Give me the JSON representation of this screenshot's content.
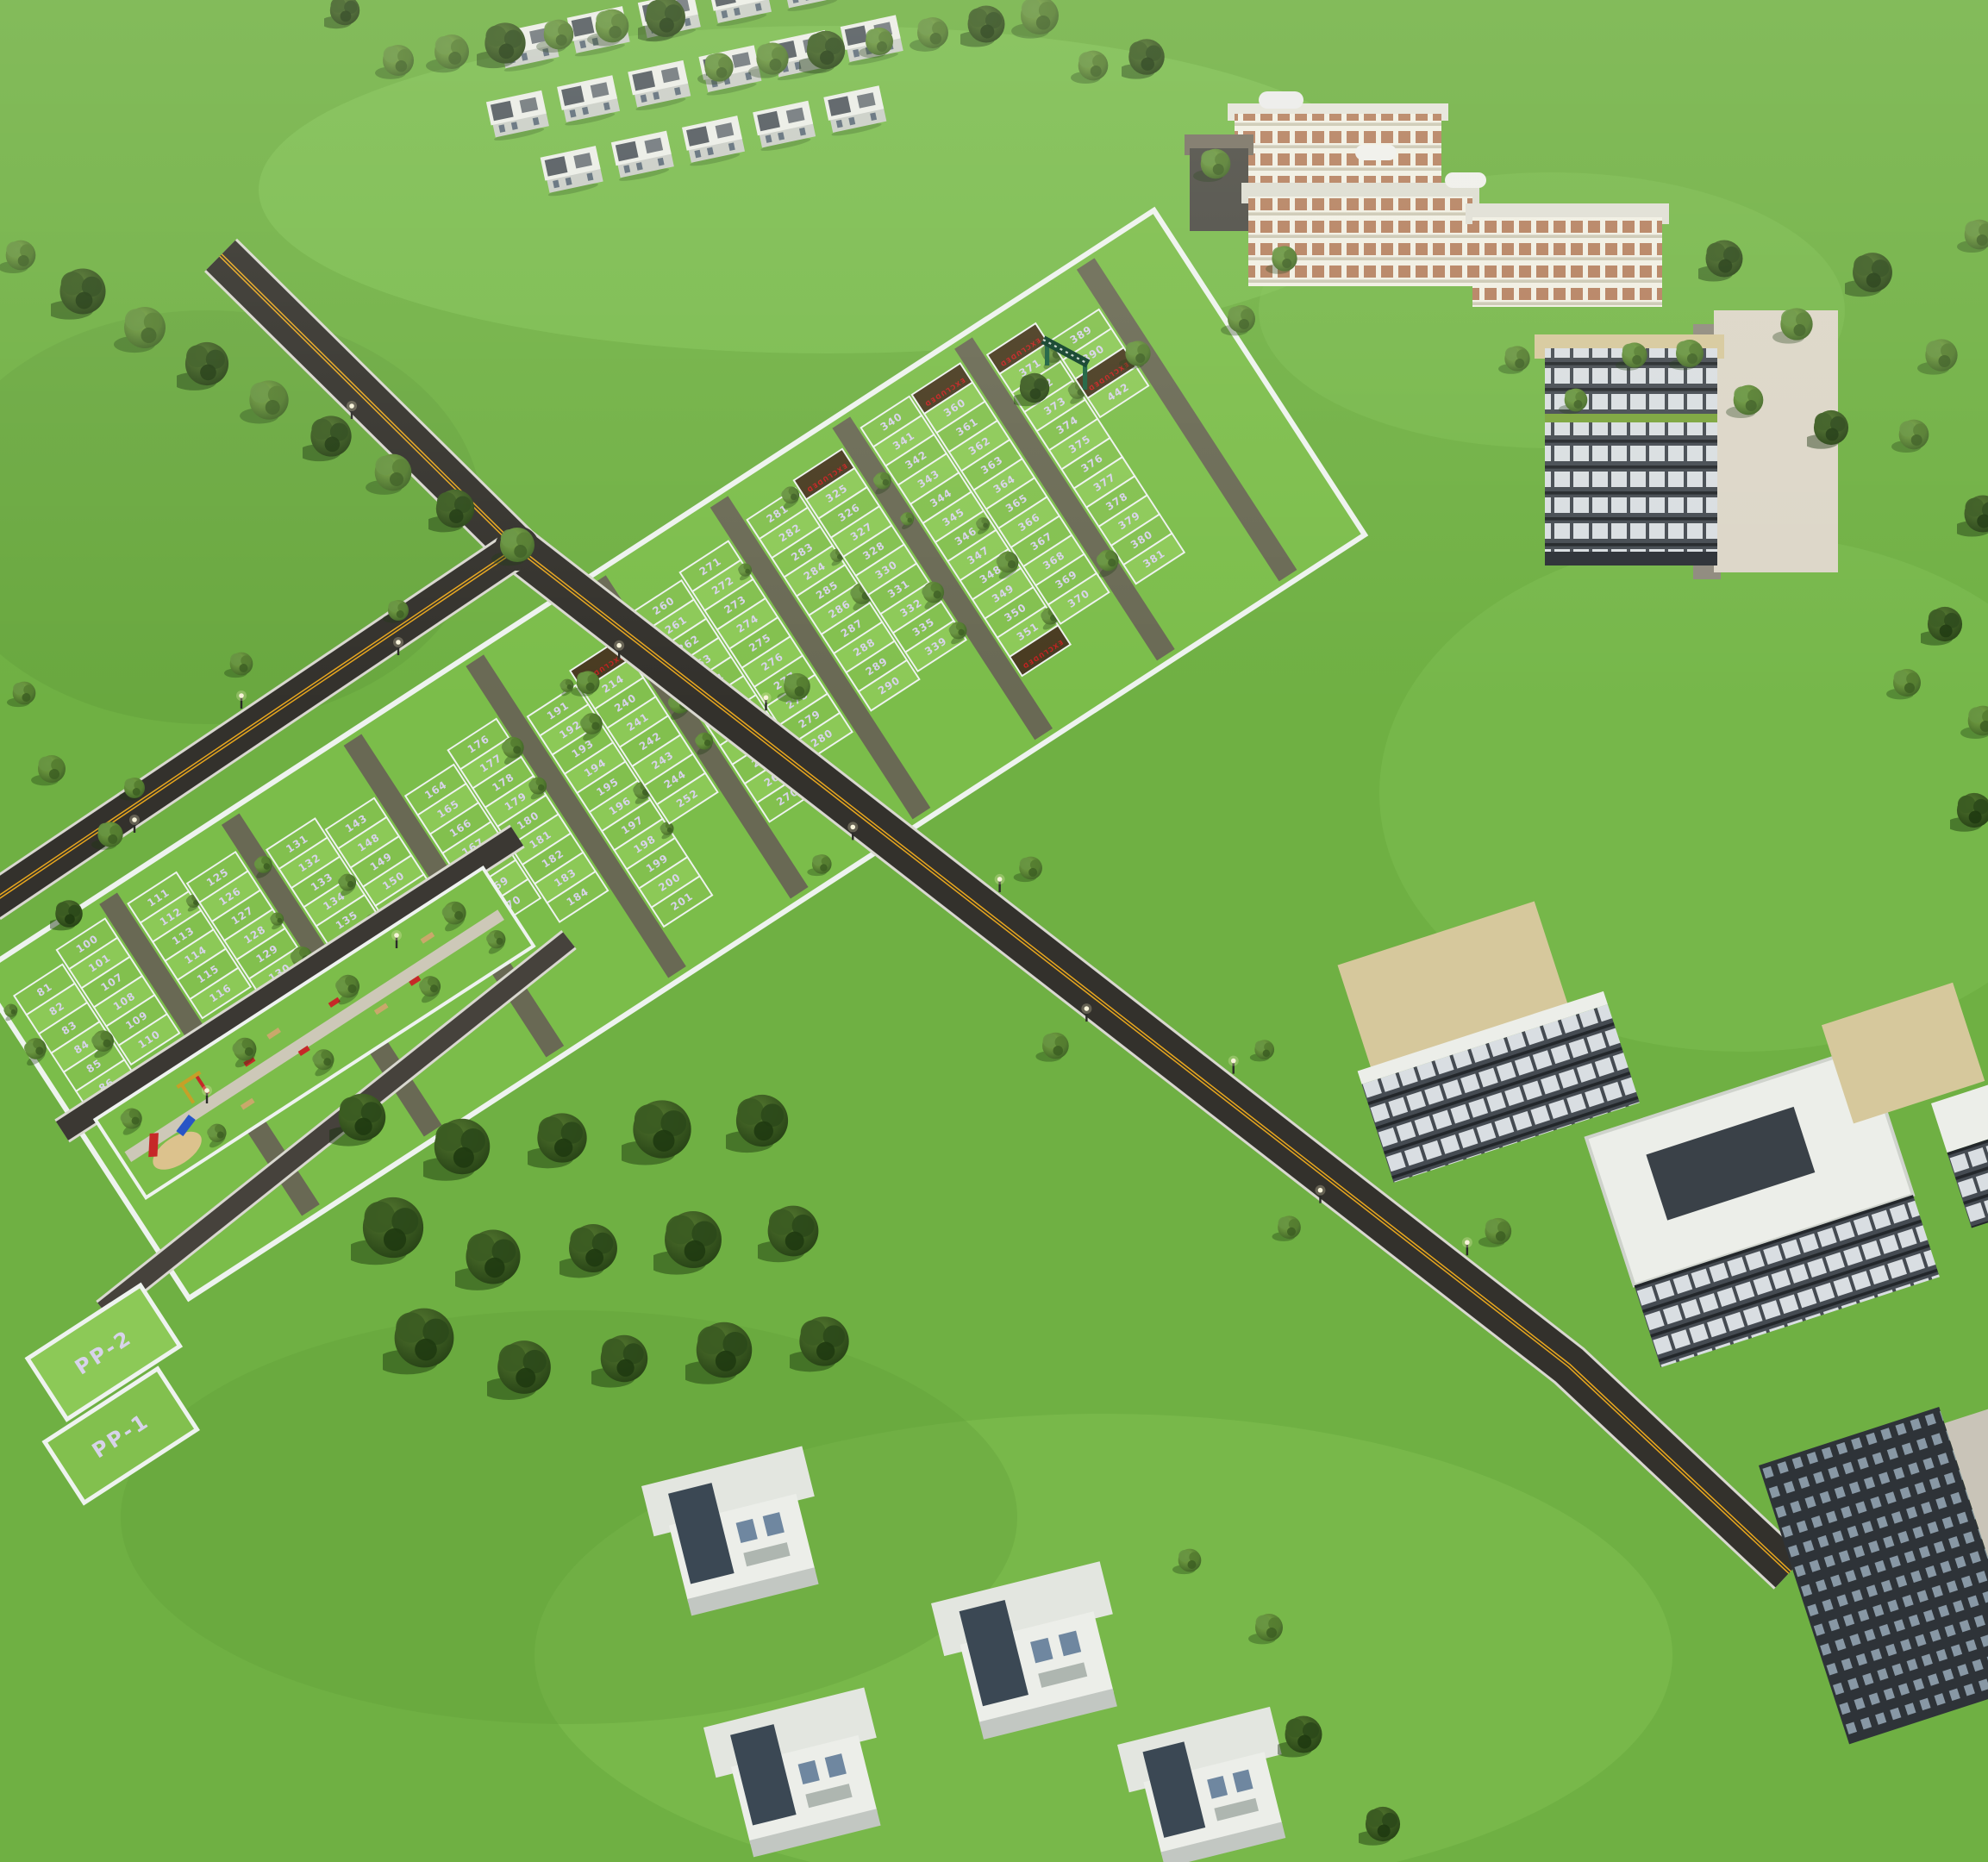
{
  "scene": {
    "labels": {
      "excluded": "EXCLUDED",
      "pp1": "PP-1",
      "pp2": "PP-2"
    },
    "plot_strips": [
      [
        "81",
        "82",
        "83",
        "84",
        "85",
        "86"
      ],
      [
        "100",
        "101",
        "107",
        "108",
        "109",
        "110"
      ],
      [
        "111",
        "112",
        "113",
        "114",
        "115",
        "116"
      ],
      [
        "125",
        "126",
        "127",
        "128",
        "129",
        "130"
      ],
      [
        "131",
        "132",
        "133",
        "134",
        "135",
        "136",
        "137",
        "138"
      ],
      [
        "143",
        "148",
        "149",
        "150",
        "151",
        "152",
        "153"
      ],
      [
        "164",
        "165",
        "166",
        "167",
        "168",
        "169",
        "170"
      ],
      [
        "176",
        "177",
        "178",
        "179",
        "180",
        "181",
        "182",
        "183",
        "184"
      ],
      [
        "191",
        "192",
        "193",
        "194",
        "195",
        "196",
        "197",
        "198",
        "199",
        "200",
        "201"
      ],
      [
        "EXCLUDED",
        "214",
        "240",
        "241",
        "242",
        "243",
        "244",
        "252"
      ],
      [
        "260",
        "261",
        "262",
        "263",
        "264",
        "265",
        "266",
        "267",
        "268",
        "269",
        "270"
      ],
      [
        "271",
        "272",
        "273",
        "274",
        "275",
        "276",
        "277",
        "278",
        "279",
        "280"
      ],
      [
        "281",
        "282",
        "283",
        "284",
        "285",
        "286",
        "287",
        "288",
        "289",
        "290"
      ],
      [
        "EXCLUDED",
        "325",
        "326",
        "327",
        "328",
        "330",
        "331",
        "332",
        "335",
        "339"
      ],
      [
        "340",
        "341",
        "342",
        "343",
        "344",
        "345",
        "346",
        "347",
        "348",
        "349",
        "350",
        "351",
        "EXCLUDED"
      ],
      [
        "EXCLUDED",
        "360",
        "361",
        "362",
        "363",
        "364",
        "365",
        "366",
        "367",
        "368",
        "369",
        "370"
      ],
      [
        "EXCLUDED",
        "371",
        "372",
        "373",
        "374",
        "375",
        "376",
        "377",
        "378",
        "379",
        "380",
        "381"
      ],
      [
        "389",
        "390",
        "EXCLUDED",
        "442"
      ]
    ],
    "park_features": [
      "playground",
      "red-slide",
      "blue-slide",
      "swing-set",
      "sandpit",
      "walkway",
      "benches",
      "outdoor-gym"
    ],
    "building_names": [
      "villa-rows",
      "school-building",
      "apartment-block",
      "apartment-cluster",
      "bottom-villas"
    ],
    "road_marking": "double-yellow-center-line",
    "colors": {
      "grass": "#6fb043",
      "grass_light": "#82c455",
      "grass_shade": "#5f9c38",
      "plot_green": "#8cc957",
      "plot_green_alt": "#82c04e",
      "plot_base": "#7bbd4a",
      "road_asphalt": "#33312c",
      "street_grey": "#675f55",
      "road_edge": "#d9d8d0",
      "center_line": "#e7a61e",
      "boundary_wall": "#eef3ef",
      "plot_number": "#d7d3ea",
      "excluded_fill": "#483a20",
      "excluded_text": "#c32020",
      "tree_dark": "#32501e",
      "tree_light": "#679441",
      "villa_white": "#eceee9",
      "roof_tan": "#d6c89c",
      "apartment_dark": "#3d434a",
      "school_cream": "#f1efe4",
      "window_rust": "#b58060",
      "arch_green": "#1a6140",
      "park_green": "#7cbd4a",
      "sand": "#dcc28d",
      "play_red": "#c62828",
      "play_blue": "#2855c6",
      "play_yellow": "#c6a028",
      "bench_tan": "#c9a86b"
    }
  }
}
